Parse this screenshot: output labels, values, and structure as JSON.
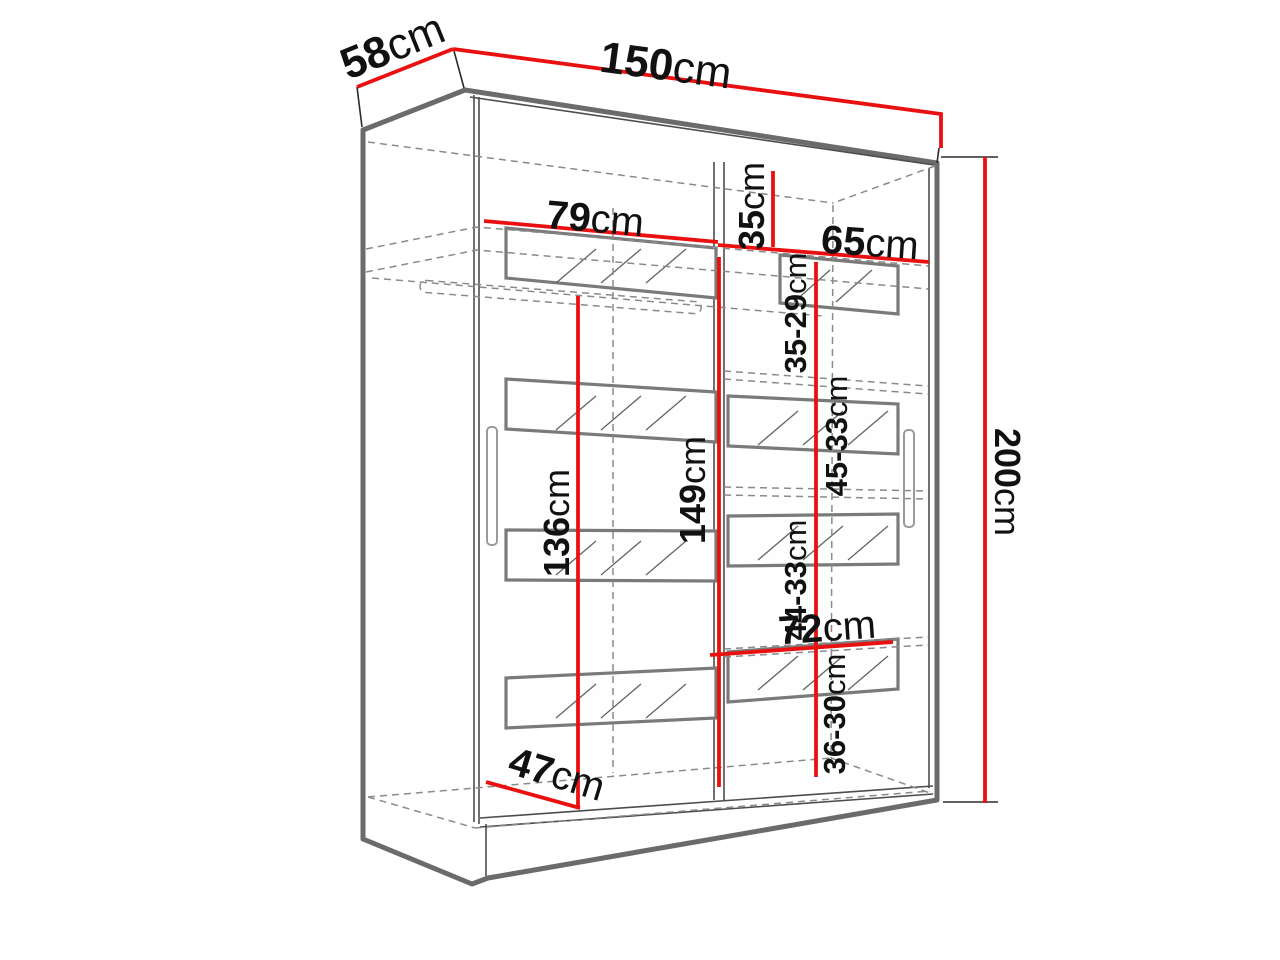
{
  "colors": {
    "dimension_red": "#ea1010",
    "outline_gray": "#6b6b6b",
    "detail_dark": "#4d4d4d",
    "hidden_gray": "#8a8a8a",
    "frame_gray": "#7a7a7a",
    "background": "#ffffff"
  },
  "dimensions": {
    "depth": {
      "value": "58",
      "unit": "cm"
    },
    "width": {
      "value": "150",
      "unit": "cm"
    },
    "height": {
      "value": "200",
      "unit": "cm"
    },
    "top_left_width": {
      "value": "79",
      "unit": "cm"
    },
    "top_shelf_height": {
      "value": "35",
      "unit": "cm"
    },
    "top_right_width": {
      "value": "65",
      "unit": "cm"
    },
    "right_compartment_1": {
      "value": "35-29",
      "unit": "cm"
    },
    "right_compartment_2": {
      "value": "45-33",
      "unit": "cm"
    },
    "right_compartment_3": {
      "value": "44-33",
      "unit": "cm"
    },
    "right_compartment_4": {
      "value": "36-30",
      "unit": "cm"
    },
    "hanging_height": {
      "value": "136",
      "unit": "cm"
    },
    "interior_height": {
      "value": "149",
      "unit": "cm"
    },
    "bottom_right_width": {
      "value": "72",
      "unit": "cm"
    },
    "interior_depth": {
      "value": "47",
      "unit": "cm"
    }
  }
}
